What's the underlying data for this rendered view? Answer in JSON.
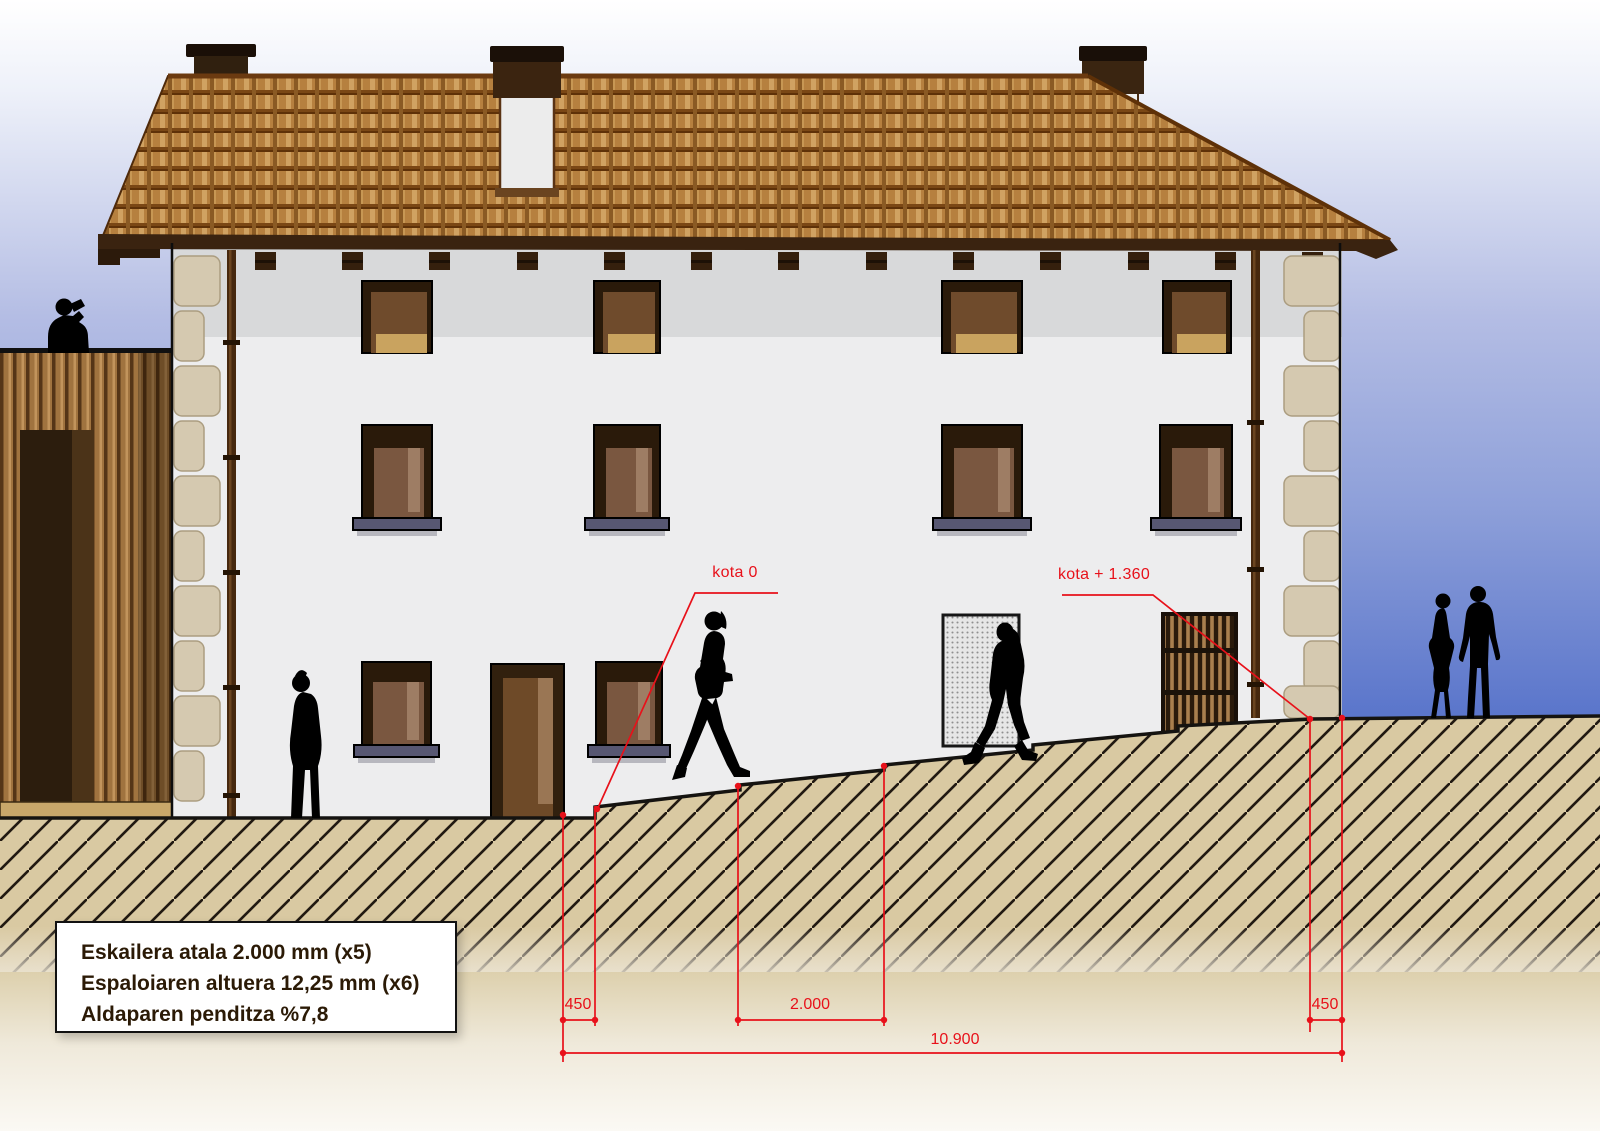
{
  "drawing": {
    "labels": {
      "kota_zero": "kota 0",
      "kota_plus_1360": "kota + 1.360"
    },
    "dimensions": {
      "sidewalk_left_mm": "450",
      "stair_tread_mm": "2.000",
      "sidewalk_right_mm": "450",
      "total_length_mm": "10.900"
    },
    "legend": {
      "lines": [
        "Eskailera atala 2.000 mm (x5)",
        "Espaloiaren altuera 12,25 mm (x6)",
        "Aldaparen penditza %7,8"
      ]
    },
    "figures": [
      "man-on-phone-on-annex-roof",
      "person-standing-at-facade",
      "woman-walking-up-slope",
      "man-walking-down-slope",
      "couple-standing-right"
    ],
    "palette": {
      "annotation_red": "#e8111a",
      "sky_top": "#ffffff",
      "sky_bottom": "#3f5cbe",
      "earth_beige": "#d9c9a2",
      "roof_tile": "#b6803f",
      "wall_white": "#ededee",
      "wood_brown": "#a0733f",
      "stone_quoin": "#d5c9b0",
      "silhouette_black": "#000000"
    }
  }
}
